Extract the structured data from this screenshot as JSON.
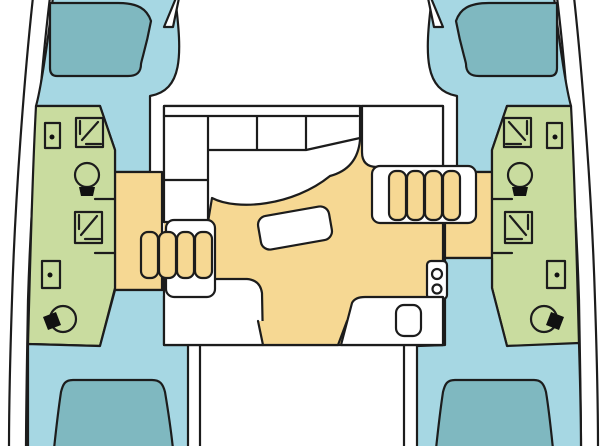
{
  "page": {
    "title": "Catamaran interior deck floor plan",
    "description": "Top-down layout diagram of a four-cabin sailing catamaran: twin hulls with forward and aft double berths and head compartments, central bridgedeck saloon with L-shaped settee, dining table, galley and companionway steps down into each hull.",
    "orientation": "bows at top, cockpit at bottom"
  },
  "colors": {
    "background": "#ffffff",
    "outline": "#1c1c1c",
    "hull_floor": "#a6d7e3",
    "berth": "#7fb8c0",
    "head": "#c9dc9f",
    "sole": "#f6d893",
    "furniture": "#ffffff",
    "fixture_dark": "#111111"
  },
  "legend": {
    "hull_floor": "hull cabin floor",
    "berth": "double berth / bed",
    "head": "head and shower compartments",
    "sole": "saloon sole, passageways and companionway steps",
    "furniture": "furniture: settee, table, galley, counters"
  },
  "areas": {
    "port_hull": {
      "label": "Port hull (left)",
      "rooms": [
        "bow locker",
        "forward berth",
        "forward head with shower, sink and toilet",
        "midship shower stall",
        "aft head with sink and toilet",
        "companionway steps",
        "aft berth"
      ]
    },
    "starboard_hull": {
      "label": "Starboard hull (right)",
      "rooms": [
        "bow locker",
        "forward berth",
        "forward head with shower, sink and toilet",
        "midship shower stall",
        "aft head with sink and toilet",
        "companionway steps",
        "aft berth"
      ]
    },
    "saloon": {
      "label": "Saloon (bridgedeck)",
      "features": [
        "L-shaped settee",
        "dining table",
        "forward cabinet / nav station",
        "two-burner stove",
        "galley sink",
        "aft counters",
        "cockpit doorway"
      ]
    },
    "foredeck": {
      "label": "Foredeck between bows"
    },
    "cockpit": {
      "label": "Aft cockpit (cropped at image edge)"
    }
  },
  "counts": {
    "berths": 4,
    "toilets": 4,
    "showers": 4,
    "sinks": 4,
    "step_flights": 2,
    "steps_per_flight": 4,
    "stove_burners": 2
  }
}
